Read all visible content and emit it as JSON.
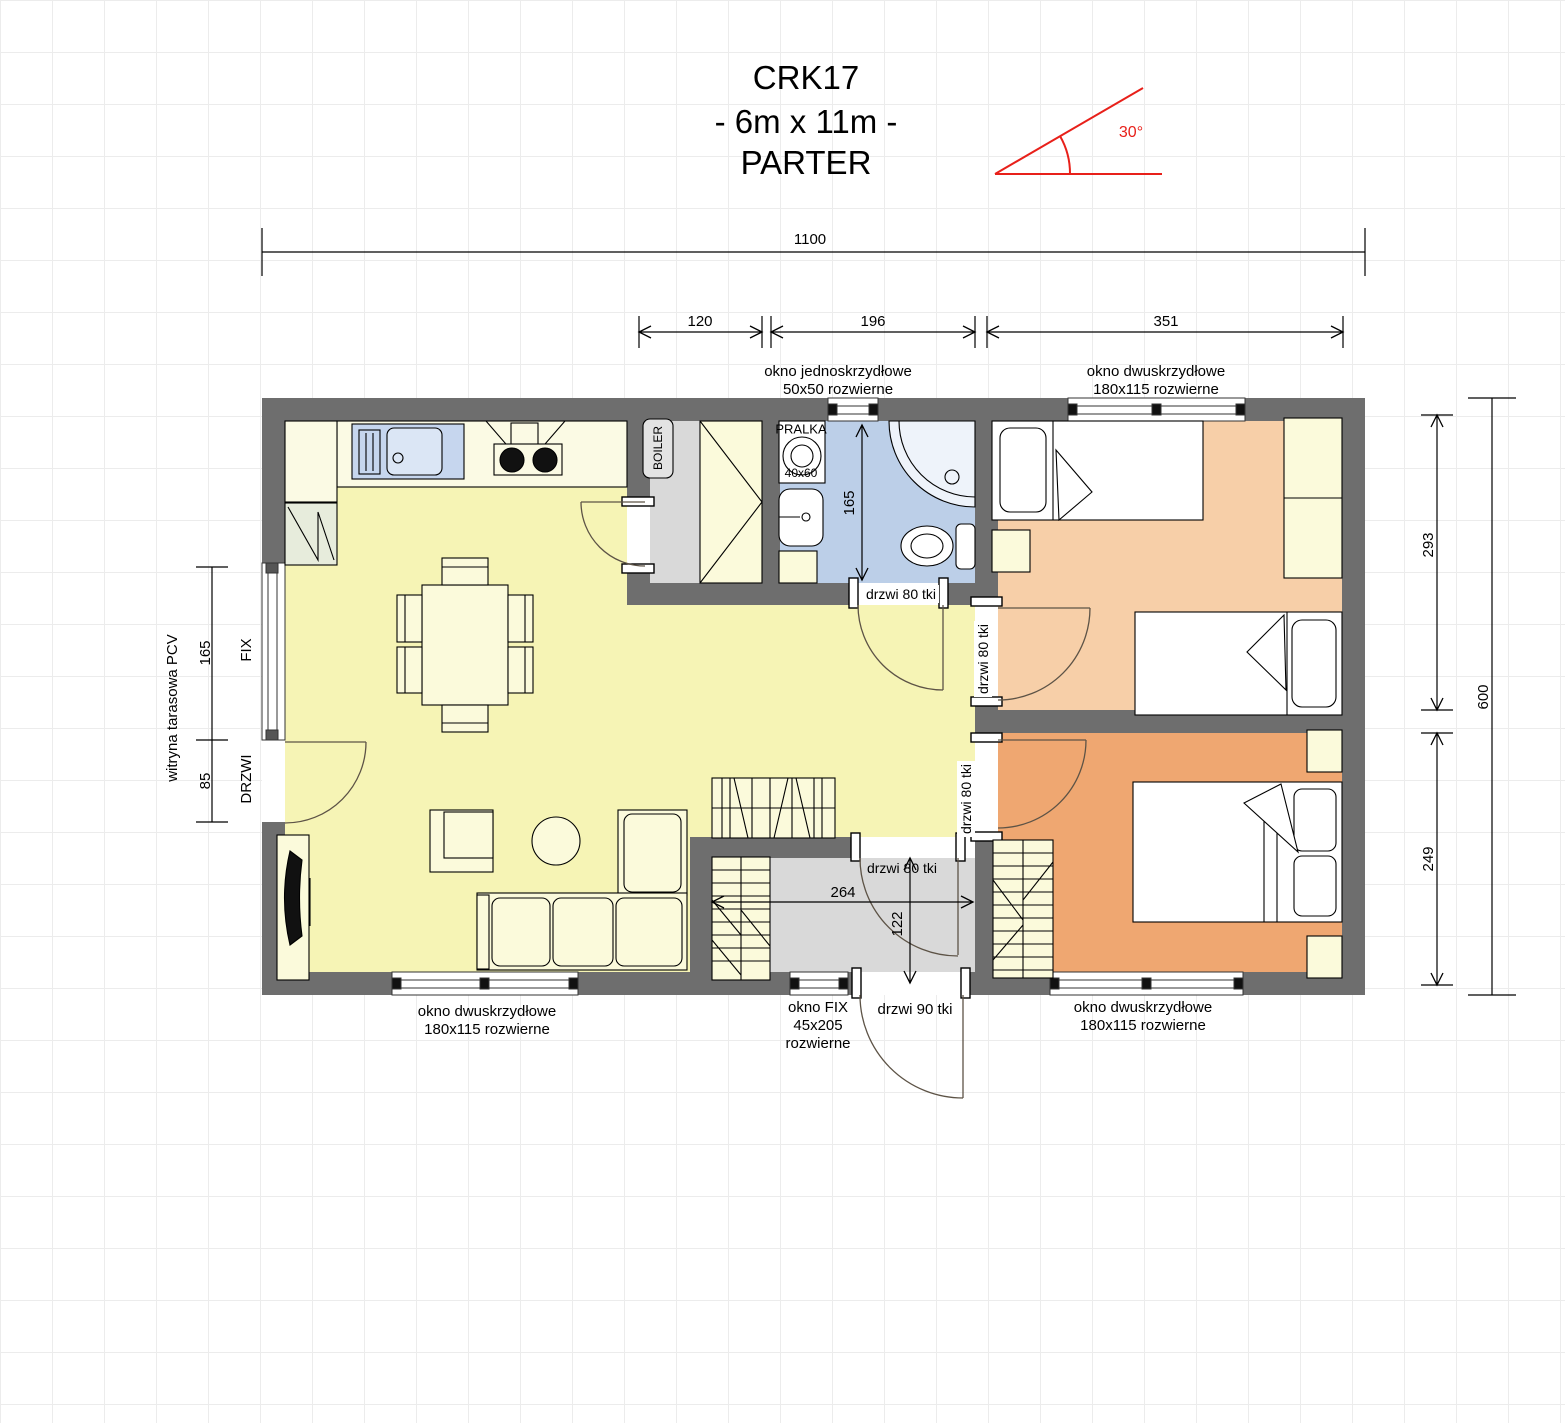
{
  "title": {
    "code": "CRK17",
    "dimensions": "- 6m x 11m -",
    "floor": "PARTER"
  },
  "roof": {
    "angle": "30°"
  },
  "dimensions": {
    "total_width": "1100",
    "utility_width": "120",
    "bathroom_width": "196",
    "bedroom_width": "351",
    "terrace_window_height": "165",
    "terrace_window_type": "FIX",
    "terrace_door_height": "85",
    "terrace_door_type": "DRZWI",
    "terrace_system": "witryna tarasowa PCV",
    "bedroom1_depth": "293",
    "total_depth": "600",
    "bedroom2_depth": "249",
    "bathroom_depth": "165",
    "hall_width": "264",
    "hall_depth": "122"
  },
  "windows": {
    "top_single": {
      "line1": "okno jednoskrzydłowe",
      "line2": "50x50 rozwierne"
    },
    "bedroom1": {
      "line1": "okno dwuskrzydłowe",
      "line2": "180x115 rozwierne"
    },
    "living": {
      "line1": "okno dwuskrzydłowe",
      "line2": "180x115 rozwierne"
    },
    "entry_fix": {
      "line1": "okno FIX",
      "line2": "45x205",
      "line3": "rozwierne"
    },
    "bedroom2": {
      "line1": "okno dwuskrzydłowe",
      "line2": "180x115 rozwierne"
    }
  },
  "doors": {
    "bathroom": "drzwi 80 tki",
    "bedroom1": "drzwi 80 tki",
    "bedroom2": "drzwi 80 tki",
    "hall": "drzwi 80 tki",
    "entry": "drzwi 90 tki"
  },
  "equipment": {
    "washer": "PRALKA",
    "washer_size": "40x60",
    "boiler": "BOILER"
  },
  "colors": {
    "wall": "#6e6e6e",
    "floor-living": "#f6f4b5",
    "floor-bath": "#bccfe8",
    "floor-gray": "#d9d9d9",
    "floor-bed1": "#f7cfa8",
    "floor-bed2": "#efa771",
    "furn": "#fbfadb",
    "counter": "#fbfae4",
    "sink": "#c6d6ee",
    "fridge": "#e7ecdc",
    "red": "#e8201a"
  }
}
